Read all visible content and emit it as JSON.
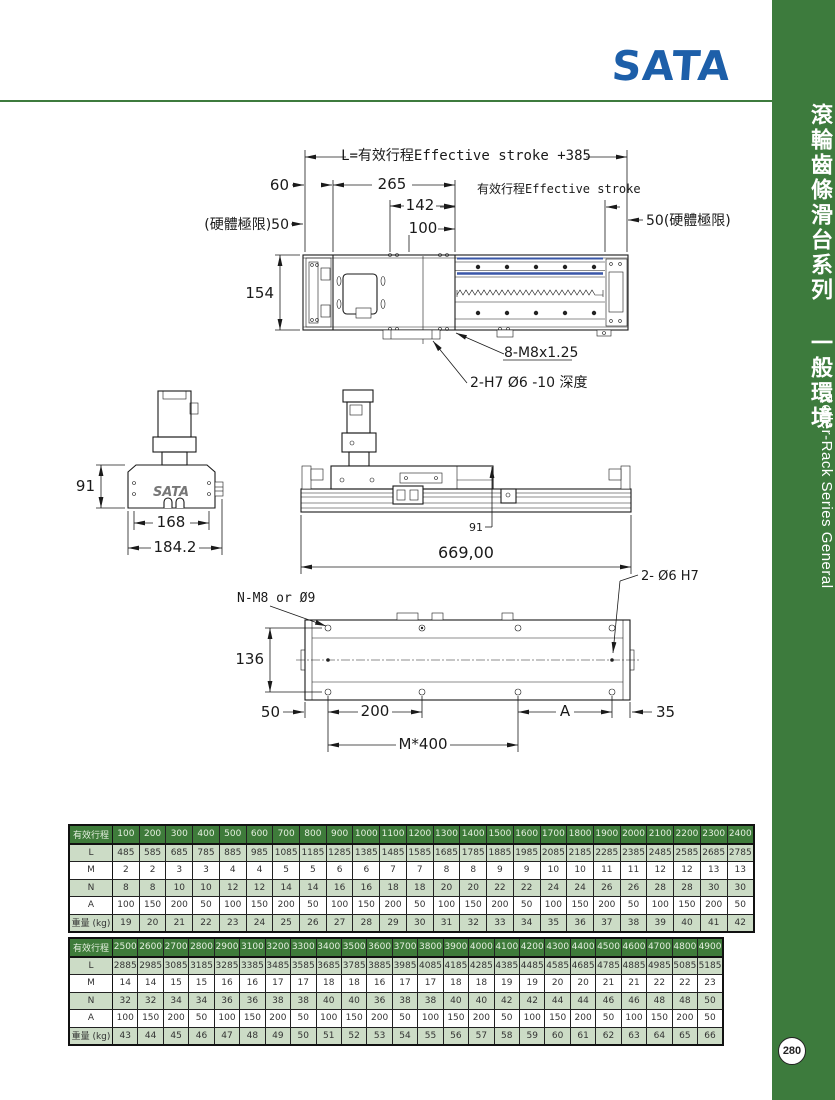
{
  "logo": {
    "text": "SATA",
    "color": "#1d5fa9"
  },
  "sidebar": {
    "title_zh": "滾輪齒條滑台系列 一般環境",
    "title_en": "Roller-Rack Series General",
    "page_number": "280",
    "color": "#3d7b3d"
  },
  "drawings": {
    "top_view": {
      "dim_total": "L=有效行程Effective stroke +385",
      "dim_60": "60",
      "dim_265": "265",
      "dim_142": "142",
      "dim_100": "100",
      "limit_left": "(硬體極限)50",
      "limit_right": "50(硬體極限)",
      "stroke_label": "有效行程Effective stroke",
      "dim_154": "154",
      "callout_m8": "8-M8x1.25",
      "callout_h7": "2-H7 Ø6 -10 深度"
    },
    "end_view": {
      "dim_91": "91",
      "dim_168": "168",
      "dim_184": "184.2",
      "logo": "SATA"
    },
    "side_view": {
      "dim_91": "91",
      "dim_669": "669,00",
      "callout_dowel": "2- Ø6 H7"
    },
    "bottom_view": {
      "callout_n": "N-M8 or Ø9",
      "dim_136": "136",
      "dim_50": "50",
      "dim_200": "200",
      "dim_a": "A",
      "dim_35": "35",
      "dim_m400": "M*400"
    }
  },
  "tables": [
    {
      "name": "spec-table-1",
      "header": [
        "有效行程",
        "100",
        "200",
        "300",
        "400",
        "500",
        "600",
        "700",
        "800",
        "900",
        "1000",
        "1100",
        "1200",
        "1300",
        "1400",
        "1500",
        "1600",
        "1700",
        "1800",
        "1900",
        "2000",
        "2100",
        "2200",
        "2300",
        "2400"
      ],
      "rows": [
        [
          "L",
          "485",
          "585",
          "685",
          "785",
          "885",
          "985",
          "1085",
          "1185",
          "1285",
          "1385",
          "1485",
          "1585",
          "1685",
          "1785",
          "1885",
          "1985",
          "2085",
          "2185",
          "2285",
          "2385",
          "2485",
          "2585",
          "2685",
          "2785"
        ],
        [
          "M",
          "2",
          "2",
          "3",
          "3",
          "4",
          "4",
          "5",
          "5",
          "6",
          "6",
          "7",
          "7",
          "8",
          "8",
          "9",
          "9",
          "10",
          "10",
          "11",
          "11",
          "12",
          "12",
          "13",
          "13"
        ],
        [
          "N",
          "8",
          "8",
          "10",
          "10",
          "12",
          "12",
          "14",
          "14",
          "16",
          "16",
          "18",
          "18",
          "20",
          "20",
          "22",
          "22",
          "24",
          "24",
          "26",
          "26",
          "28",
          "28",
          "30",
          "30"
        ],
        [
          "A",
          "100",
          "150",
          "200",
          "50",
          "100",
          "150",
          "200",
          "50",
          "100",
          "150",
          "200",
          "50",
          "100",
          "150",
          "200",
          "50",
          "100",
          "150",
          "200",
          "50",
          "100",
          "150",
          "200",
          "50"
        ],
        [
          "重量 (kg)",
          "19",
          "20",
          "21",
          "22",
          "23",
          "24",
          "25",
          "26",
          "27",
          "28",
          "29",
          "30",
          "31",
          "32",
          "33",
          "34",
          "35",
          "36",
          "37",
          "38",
          "39",
          "40",
          "41",
          "42"
        ]
      ]
    },
    {
      "name": "spec-table-2",
      "header": [
        "有效行程",
        "2500",
        "2600",
        "2700",
        "2800",
        "2900",
        "3100",
        "3200",
        "3300",
        "3400",
        "3500",
        "3600",
        "3700",
        "3800",
        "3900",
        "4000",
        "4100",
        "4200",
        "4300",
        "4400",
        "4500",
        "4600",
        "4700",
        "4800",
        "4900"
      ],
      "rows": [
        [
          "L",
          "2885",
          "2985",
          "3085",
          "3185",
          "3285",
          "3385",
          "3485",
          "3585",
          "3685",
          "3785",
          "3885",
          "3985",
          "4085",
          "4185",
          "4285",
          "4385",
          "4485",
          "4585",
          "4685",
          "4785",
          "4885",
          "4985",
          "5085",
          "5185"
        ],
        [
          "M",
          "14",
          "14",
          "15",
          "15",
          "16",
          "16",
          "17",
          "17",
          "18",
          "18",
          "16",
          "17",
          "17",
          "18",
          "18",
          "19",
          "19",
          "20",
          "20",
          "21",
          "21",
          "22",
          "22",
          "23"
        ],
        [
          "N",
          "32",
          "32",
          "34",
          "34",
          "36",
          "36",
          "38",
          "38",
          "40",
          "40",
          "36",
          "38",
          "38",
          "40",
          "40",
          "42",
          "42",
          "44",
          "44",
          "46",
          "46",
          "48",
          "48",
          "50"
        ],
        [
          "A",
          "100",
          "150",
          "200",
          "50",
          "100",
          "150",
          "200",
          "50",
          "100",
          "150",
          "200",
          "50",
          "100",
          "150",
          "200",
          "50",
          "100",
          "150",
          "200",
          "50",
          "100",
          "150",
          "200",
          "50"
        ],
        [
          "重量 (kg)",
          "43",
          "44",
          "45",
          "46",
          "47",
          "48",
          "49",
          "50",
          "51",
          "52",
          "53",
          "54",
          "55",
          "56",
          "57",
          "58",
          "59",
          "60",
          "61",
          "62",
          "63",
          "64",
          "65",
          "66"
        ]
      ]
    }
  ]
}
